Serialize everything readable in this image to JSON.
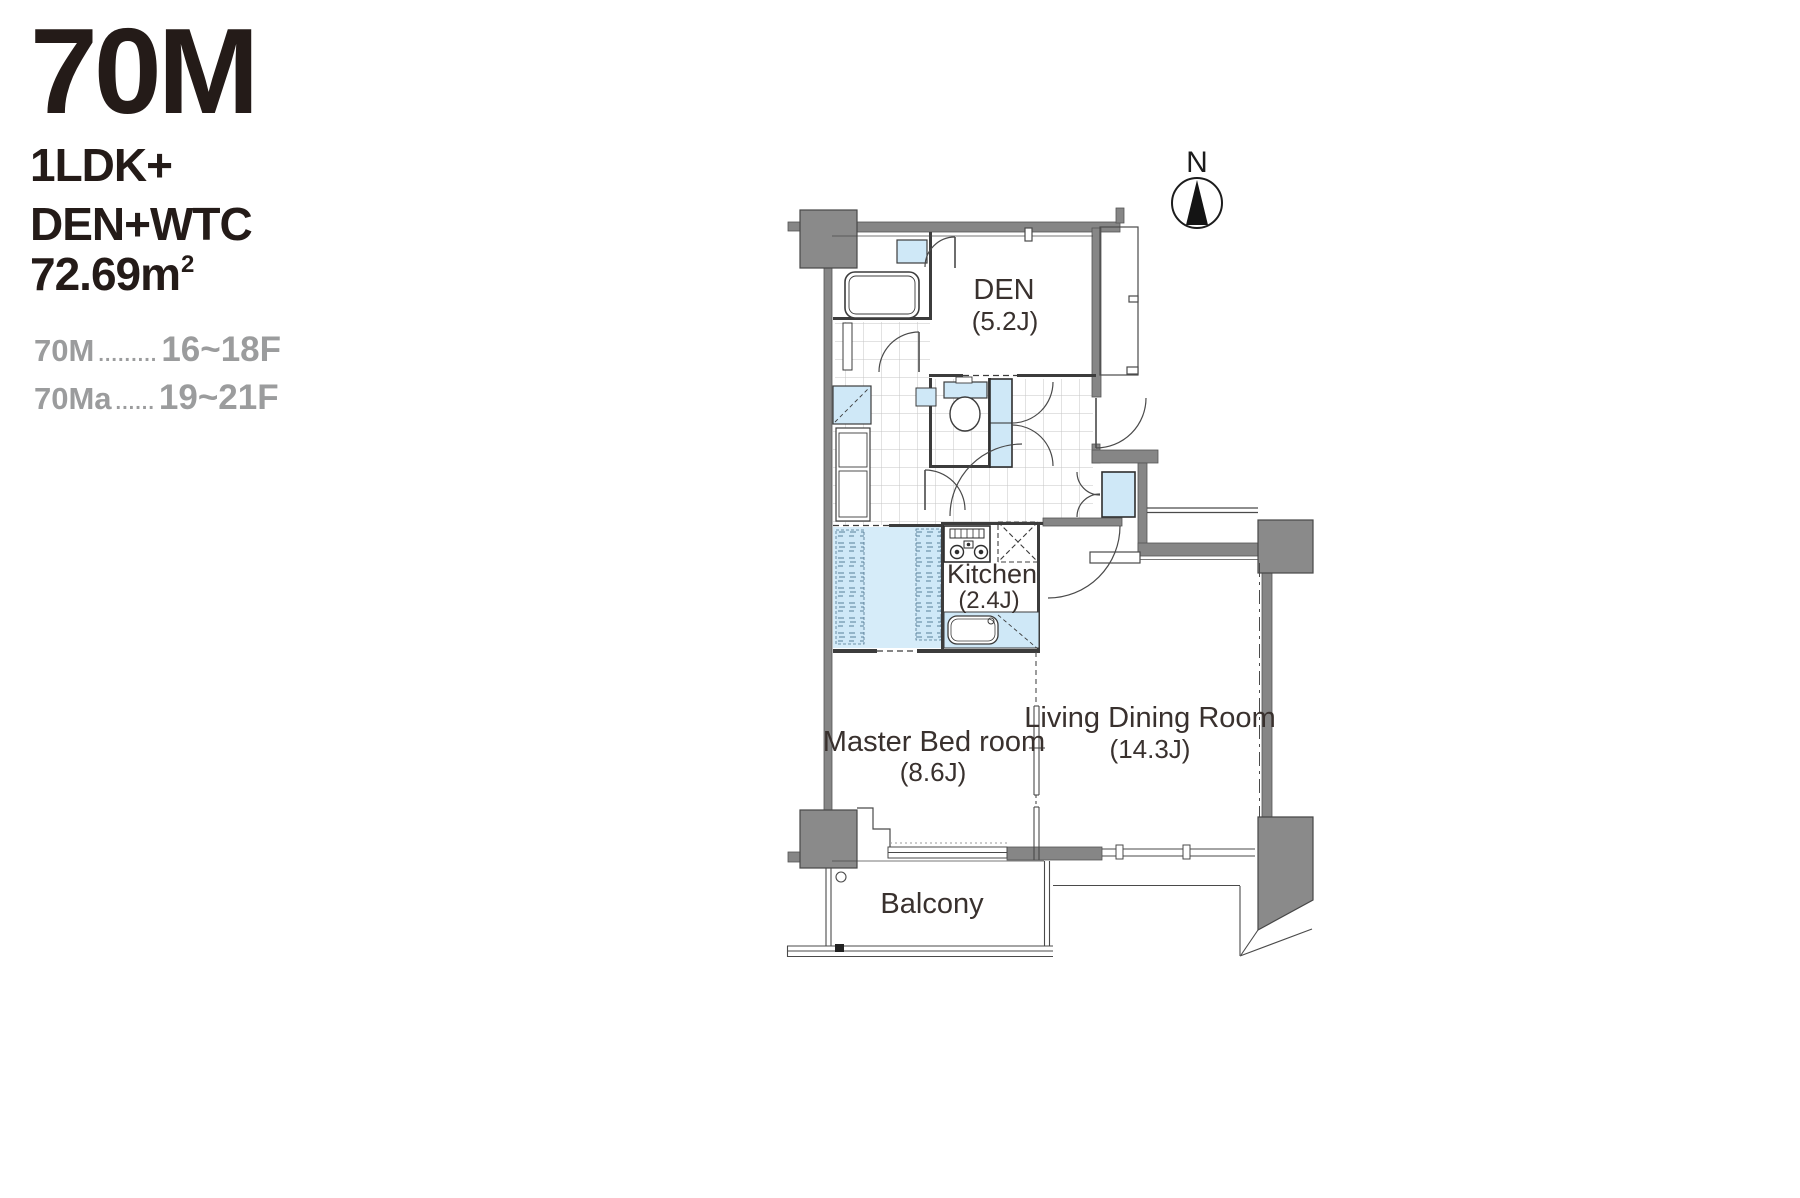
{
  "title": {
    "code": "70M",
    "type_line1": "1LDK+",
    "type_line2": "DEN+WTC",
    "area_main": "72.69m",
    "area_sup": "2"
  },
  "floor_listing": [
    {
      "label": "70M",
      "dots": ".........",
      "range": "16~18F"
    },
    {
      "label": "70Ma",
      "dots": "......",
      "range": "19~21F"
    }
  ],
  "compass": {
    "label": "N"
  },
  "rooms": {
    "den": {
      "name": "DEN",
      "size": "(5.2J)"
    },
    "kitchen": {
      "name": "Kitchen",
      "size": "(2.4J)"
    },
    "master_bedroom": {
      "name": "Master Bed room",
      "size": "(8.6J)"
    },
    "living_dining": {
      "name": "Living Dining Room",
      "size": "(14.3J)"
    },
    "balcony": {
      "name": "Balcony"
    }
  },
  "colors": {
    "wall_gray": "#868686",
    "column_gray": "#8a8a8a",
    "fixture_blue": "#cfe8f7",
    "closet_blue": "#d6ecf9",
    "line_dark": "#3c3c3c",
    "text_dark": "#39312e",
    "text_muted": "#9b9c9d",
    "hatch_gray": "#c6c6c6"
  }
}
